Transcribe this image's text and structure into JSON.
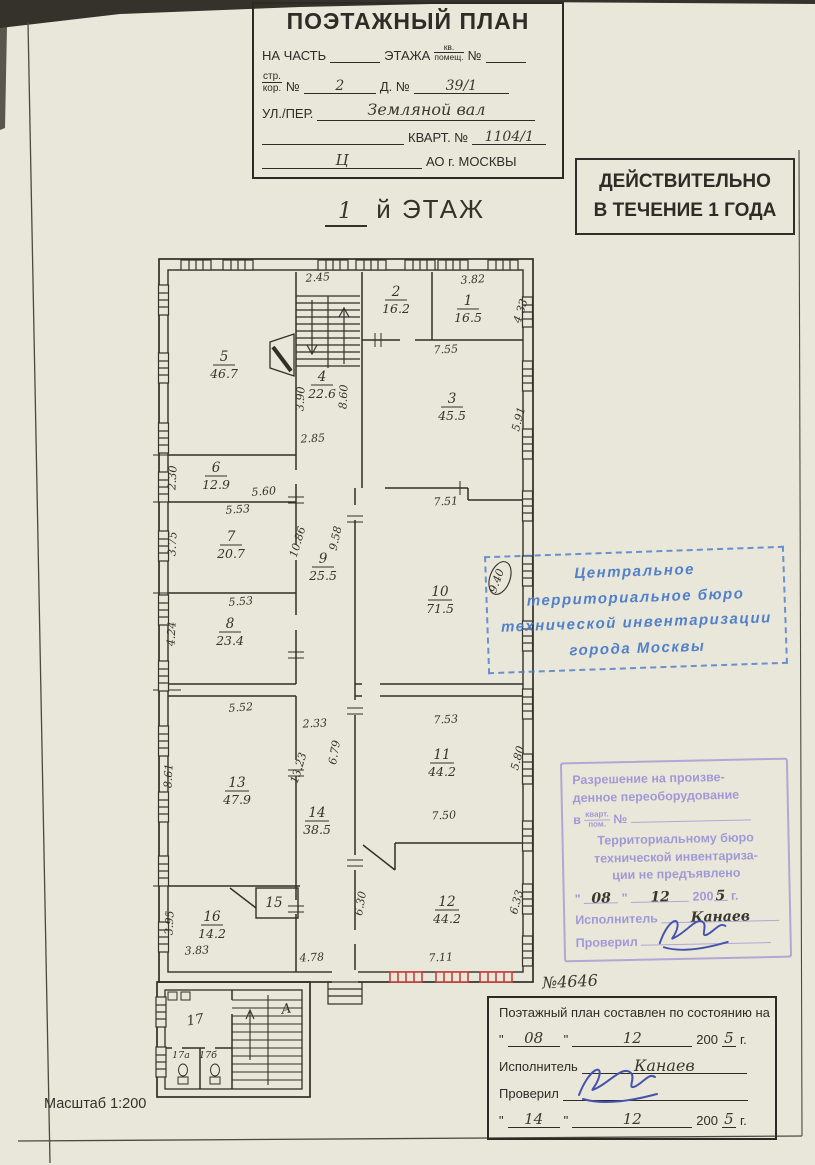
{
  "misc": {
    "quote": "\""
  },
  "header_box": {
    "title": "ПОЭТАЖНЫЙ ПЛАН",
    "r1a": "НА ЧАСТЬ",
    "r1b": "ЭТАЖА",
    "r1ft": "кв.",
    "r1fb": "помещ.",
    "r1c": "№",
    "r2ft": "стр.",
    "r2fb": "кор.",
    "r2a": "№",
    "r2v": "2",
    "r2b": "Д. №",
    "r2v2": "39/1",
    "r3a": "УЛ./ПЕР.",
    "r3v": "Земляной вал",
    "r4a": "КВАРТ. №",
    "r4v": "1104/1",
    "r5v": "Ц",
    "r5a": "АО г. МОСКВЫ"
  },
  "validity_stamp": {
    "line1": "ДЕЙСТВИТЕЛЬНО",
    "line2": "В ТЕЧЕНИЕ 1 ГОДА"
  },
  "floor_title": {
    "num": "1",
    "text": "й ЭТАЖ"
  },
  "blue_stamp": {
    "line1": "Центральное",
    "line2": "территориальное бюро",
    "line3": "технической инвентаризации",
    "line4": "города Москвы"
  },
  "purple_stamp": {
    "line1": "Разрешение на произве-",
    "line2": "денное переоборудование",
    "l3_prefix": "в",
    "l3_ft": "кварт.",
    "l3_fb": "пом.",
    "l3_no": "№",
    "line4": "Территориальному бюро",
    "line5": "технической инвентариза-",
    "line6": "ции не предъявлено",
    "date_day": "08",
    "date_month": "12",
    "date_year": "200",
    "date_year_hand": "5",
    "date_suffix": "г.",
    "executor_label": "Исполнитель",
    "executor_value": "Канаев",
    "checked_label": "Проверил"
  },
  "bottom_box": {
    "title": "Поэтажный план составлен по состоянию на",
    "date1_day": "08",
    "date1_month": "12",
    "date1_year": "200",
    "date1_year_hand": "5",
    "date1_suffix": "г.",
    "executor_label": "Исполнитель",
    "executor_value": "Канаев",
    "checked_label": "Проверил",
    "date2_day": "14",
    "date2_month": "12",
    "date2_year": "200",
    "date2_year_hand": "5",
    "date2_suffix": "г."
  },
  "plan_number": "№4646",
  "scale_label": "Масштаб 1:200",
  "plan": {
    "stair_letter": "А",
    "rooms": [
      {
        "num": "1",
        "area": "16.5"
      },
      {
        "num": "2",
        "area": "16.2"
      },
      {
        "num": "3",
        "area": "45.5"
      },
      {
        "num": "4",
        "area": "22.6"
      },
      {
        "num": "5",
        "area": "46.7"
      },
      {
        "num": "6",
        "area": "12.9"
      },
      {
        "num": "7",
        "area": "20.7"
      },
      {
        "num": "8",
        "area": "23.4"
      },
      {
        "num": "9",
        "area": "25.5"
      },
      {
        "num": "10",
        "area": "71.5"
      },
      {
        "num": "11",
        "area": "44.2"
      },
      {
        "num": "12",
        "area": "44.2"
      },
      {
        "num": "13",
        "area": "47.9"
      },
      {
        "num": "14",
        "area": "38.5"
      },
      {
        "num": "15",
        "area": ""
      },
      {
        "num": "16",
        "area": "14.2"
      },
      {
        "num": "17",
        "area": ""
      },
      {
        "num": "17а",
        "area": ""
      },
      {
        "num": "17б",
        "area": ""
      }
    ],
    "dims": [
      "2.45",
      "3.82",
      "4.33",
      "7.55",
      "5.91",
      "3.90",
      "8.60",
      "2.85",
      "2.30",
      "5.60",
      "5.53",
      "3.75",
      "10.86",
      "9.58",
      "7.51",
      "9.40",
      "5.53",
      "4.24",
      "5.52",
      "2.33",
      "7.53",
      "5.80",
      "8.61",
      "13.23",
      "6.79",
      "7.50",
      "3.95",
      "3.83",
      "4.78",
      "7.11",
      "6.30",
      "6.33"
    ]
  }
}
